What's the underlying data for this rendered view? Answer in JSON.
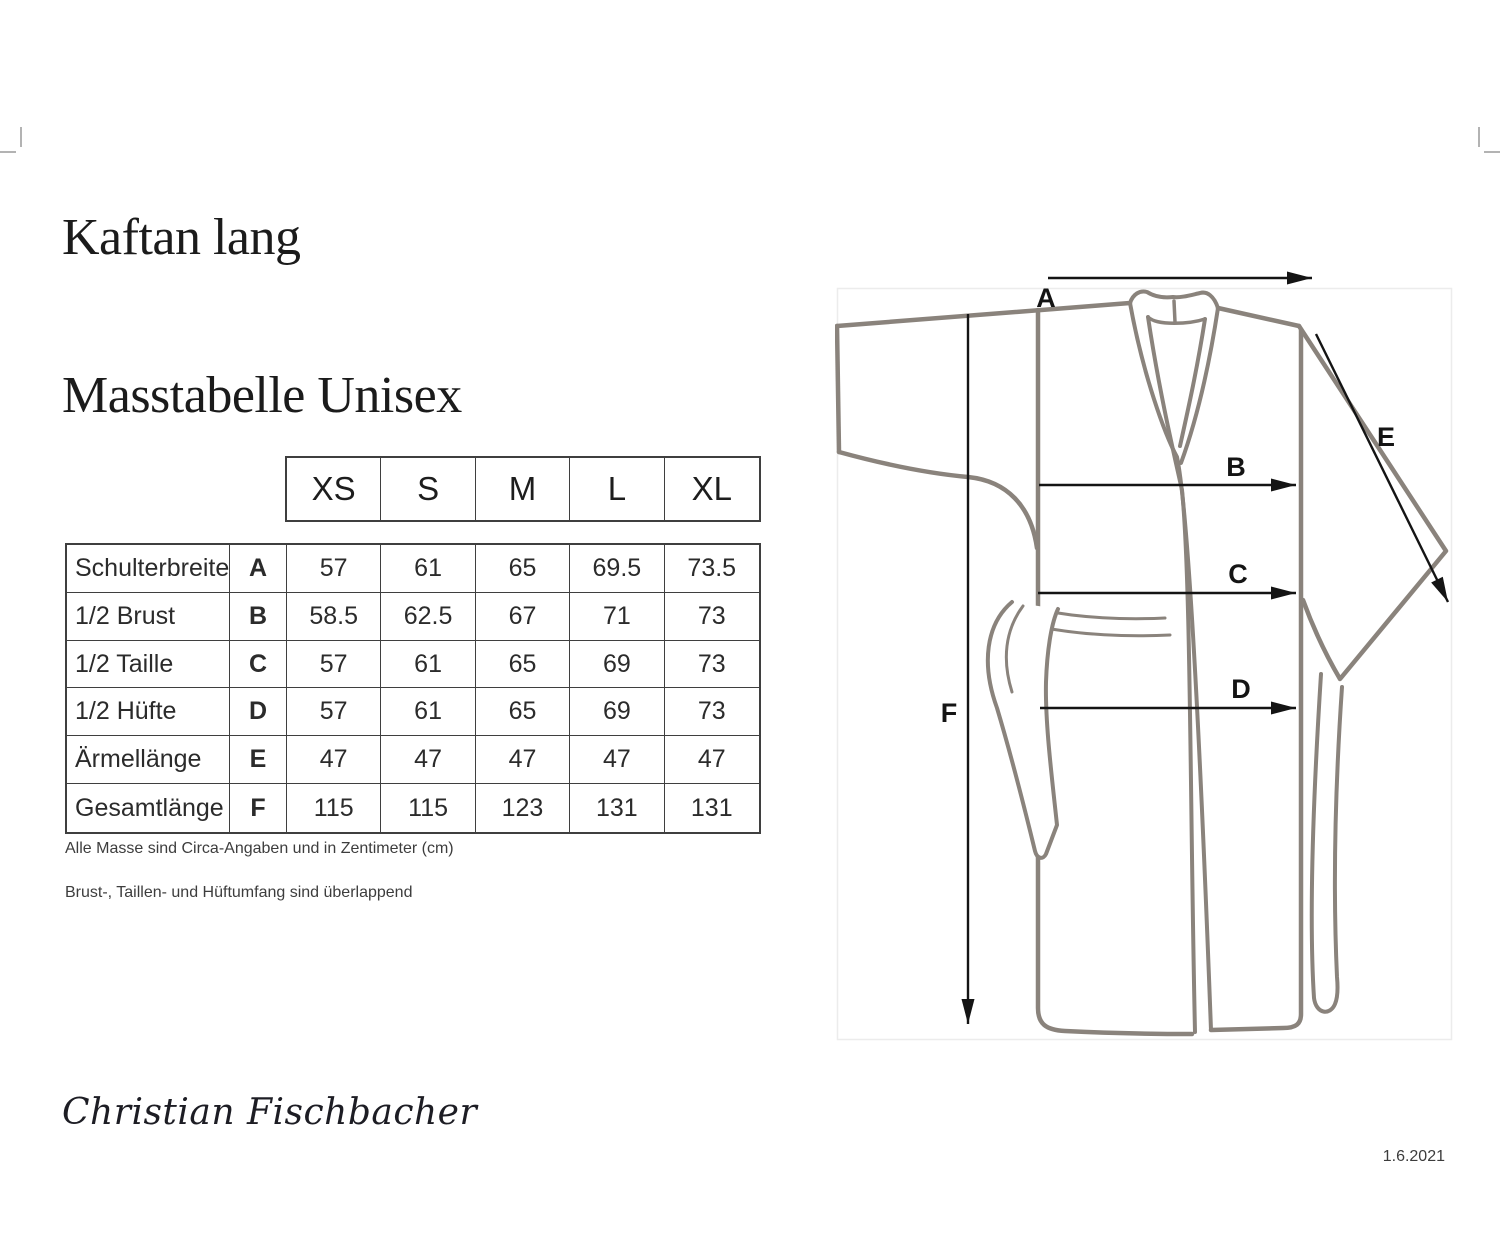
{
  "page": {
    "title_line1": "Kaftan lang",
    "title_line2": "Masstabelle Unisex"
  },
  "size_table": {
    "sizes": [
      "XS",
      "S",
      "M",
      "L",
      "XL"
    ],
    "rows": [
      {
        "label": "Schulterbreite",
        "code": "A",
        "values": [
          "57",
          "61",
          "65",
          "69.5",
          "73.5"
        ]
      },
      {
        "label": "1/2 Brust",
        "code": "B",
        "values": [
          "58.5",
          "62.5",
          "67",
          "71",
          "73"
        ]
      },
      {
        "label": "1/2 Taille",
        "code": "C",
        "values": [
          "57",
          "61",
          "65",
          "69",
          "73"
        ]
      },
      {
        "label": "1/2 Hüfte",
        "code": "D",
        "values": [
          "57",
          "61",
          "65",
          "69",
          "73"
        ]
      },
      {
        "label": "Ärmellänge",
        "code": "E",
        "values": [
          "47",
          "47",
          "47",
          "47",
          "47"
        ]
      },
      {
        "label": "Gesamtlänge",
        "code": "F",
        "values": [
          "115",
          "115",
          "123",
          "131",
          "131"
        ]
      }
    ],
    "footnote_line1": "Alle Masse sind Circa-Angaben und in Zentimeter (cm)",
    "footnote_line2": "Brust-, Taillen- und Hüftumfang sind überlappend"
  },
  "diagram": {
    "labels": {
      "a": "A",
      "b": "B",
      "c": "C",
      "d": "D",
      "e": "E",
      "f": "F"
    },
    "garment_stroke_color": "#8a837c",
    "arrow_color": "#141414"
  },
  "footer": {
    "brand": "Christian Fischbacher",
    "date": "1.6.2021"
  }
}
